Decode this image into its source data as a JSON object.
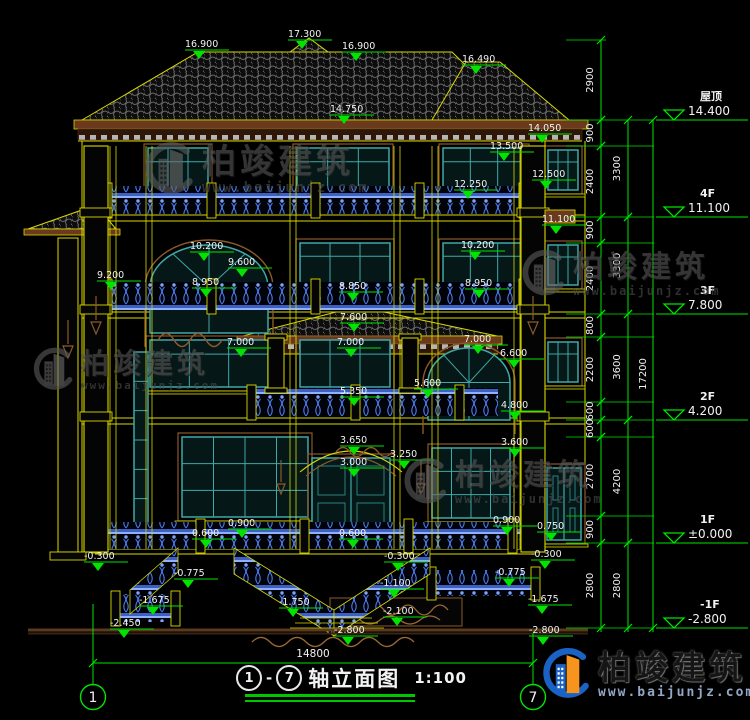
{
  "colors": {
    "green": "#00e400",
    "yellow": "#d8d800",
    "teal": "#3fa8a8",
    "blue": "#4a78e8",
    "brown": "#8a5a2b",
    "white": "#f2f2f2"
  },
  "brand": {
    "name": "柏竣建筑",
    "url": "www.baijunjz.com"
  },
  "title_block": {
    "axis_start": "1",
    "axis_end": "7",
    "separator": "-",
    "title": "轴立面图",
    "scale": "1:100"
  },
  "overall_dimension": "14800",
  "axis_bubbles": [
    {
      "label": "1",
      "x": 93,
      "y": 697
    },
    {
      "label": "7",
      "x": 533,
      "y": 697
    }
  ],
  "levels": [
    {
      "name": "屋顶",
      "value": "14.400",
      "y": 120
    },
    {
      "name": "4F",
      "value": "11.100",
      "y": 217
    },
    {
      "name": "3F",
      "value": "7.800",
      "y": 314
    },
    {
      "name": "2F",
      "value": "4.200",
      "y": 420
    },
    {
      "name": "1F",
      "value": "±0.000",
      "y": 543
    },
    {
      "name": "-1F",
      "value": "-2.800",
      "y": 628
    }
  ],
  "dim_chains": [
    {
      "x": 601,
      "text_x": 593,
      "top": 40,
      "segments": [
        {
          "value": "2900",
          "y1": 40,
          "y2": 120
        },
        {
          "value": "900",
          "y1": 120,
          "y2": 146
        },
        {
          "value": "2400",
          "y1": 146,
          "y2": 217
        },
        {
          "value": "900",
          "y1": 217,
          "y2": 243
        },
        {
          "value": "2400",
          "y1": 243,
          "y2": 314
        },
        {
          "value": "800",
          "y1": 314,
          "y2": 337
        },
        {
          "value": "2200",
          "y1": 337,
          "y2": 402
        },
        {
          "value": "600",
          "y1": 402,
          "y2": 420
        },
        {
          "value": "600",
          "y1": 420,
          "y2": 437
        },
        {
          "value": "2700",
          "y1": 437,
          "y2": 516
        },
        {
          "value": "900",
          "y1": 516,
          "y2": 543
        },
        {
          "value": "2800",
          "y1": 543,
          "y2": 628
        }
      ]
    },
    {
      "x": 628,
      "text_x": 620,
      "top": 120,
      "segments": [
        {
          "value": "3300",
          "y1": 120,
          "y2": 217
        },
        {
          "value": "3300",
          "y1": 217,
          "y2": 314
        },
        {
          "value": "3600",
          "y1": 314,
          "y2": 420
        },
        {
          "value": "4200",
          "y1": 420,
          "y2": 543
        },
        {
          "value": "2800",
          "y1": 543,
          "y2": 628
        }
      ]
    },
    {
      "x": 653,
      "text_x": 646,
      "top": 120,
      "segments": [
        {
          "value": "17200",
          "y1": 120,
          "y2": 628
        }
      ]
    }
  ],
  "elevation_markers": [
    {
      "value": "16.900",
      "x": 205,
      "y": 50
    },
    {
      "value": "17.300",
      "x": 308,
      "y": 40
    },
    {
      "value": "16.900",
      "x": 362,
      "y": 52
    },
    {
      "value": "16.490",
      "x": 482,
      "y": 65
    },
    {
      "value": "14.750",
      "x": 350,
      "y": 115
    },
    {
      "value": "14.050",
      "x": 548,
      "y": 134
    },
    {
      "value": "13.500",
      "x": 510,
      "y": 152
    },
    {
      "value": "12.500",
      "x": 552,
      "y": 180
    },
    {
      "value": "12.250",
      "x": 474,
      "y": 190
    },
    {
      "value": "11.100",
      "x": 562,
      "y": 225
    },
    {
      "value": "10.200",
      "x": 210,
      "y": 252
    },
    {
      "value": "10.200",
      "x": 481,
      "y": 251
    },
    {
      "value": "9.600",
      "x": 248,
      "y": 268
    },
    {
      "value": "9.200",
      "x": 117,
      "y": 281
    },
    {
      "value": "8.950",
      "x": 212,
      "y": 288
    },
    {
      "value": "8.950",
      "x": 485,
      "y": 289
    },
    {
      "value": "8.850",
      "x": 359,
      "y": 292
    },
    {
      "value": "7.600",
      "x": 360,
      "y": 323
    },
    {
      "value": "7.000",
      "x": 247,
      "y": 348
    },
    {
      "value": "7.000",
      "x": 357,
      "y": 348
    },
    {
      "value": "7.000",
      "x": 484,
      "y": 345
    },
    {
      "value": "6.600",
      "x": 520,
      "y": 359
    },
    {
      "value": "5.600",
      "x": 434,
      "y": 389
    },
    {
      "value": "5.350",
      "x": 360,
      "y": 397
    },
    {
      "value": "4.800",
      "x": 521,
      "y": 411
    },
    {
      "value": "3.650",
      "x": 360,
      "y": 446
    },
    {
      "value": "3.600",
      "x": 521,
      "y": 448
    },
    {
      "value": "3.250",
      "x": 410,
      "y": 460
    },
    {
      "value": "3.000",
      "x": 360,
      "y": 468
    },
    {
      "value": "0.900",
      "x": 248,
      "y": 529
    },
    {
      "value": "0.900",
      "x": 513,
      "y": 526
    },
    {
      "value": "0.750",
      "x": 557,
      "y": 532
    },
    {
      "value": "0.600",
      "x": 212,
      "y": 539
    },
    {
      "value": "0.600",
      "x": 359,
      "y": 539
    },
    {
      "value": "-0.300",
      "x": 104,
      "y": 562
    },
    {
      "value": "-0.300",
      "x": 404,
      "y": 562
    },
    {
      "value": "-0.300",
      "x": 551,
      "y": 560
    },
    {
      "value": "-0.775",
      "x": 194,
      "y": 579
    },
    {
      "value": "-0.775",
      "x": 515,
      "y": 578
    },
    {
      "value": "-1.100",
      "x": 400,
      "y": 589
    },
    {
      "value": "-1.675",
      "x": 159,
      "y": 606
    },
    {
      "value": "-1.675",
      "x": 548,
      "y": 605
    },
    {
      "value": "-1.750",
      "x": 299,
      "y": 608
    },
    {
      "value": "-2.100",
      "x": 403,
      "y": 617
    },
    {
      "value": "-2.450",
      "x": 130,
      "y": 629
    },
    {
      "value": "-2.800",
      "x": 354,
      "y": 636
    },
    {
      "value": "-2.800",
      "x": 549,
      "y": 636
    }
  ],
  "watermarks": [
    {
      "x": 136,
      "y": 140,
      "variant": "gray",
      "text_px": 34
    },
    {
      "x": 514,
      "y": 248,
      "variant": "gray",
      "text_px": 30
    },
    {
      "x": 26,
      "y": 346,
      "variant": "gray",
      "text_px": 28
    },
    {
      "x": 396,
      "y": 456,
      "variant": "gray",
      "text_px": 30
    },
    {
      "x": 534,
      "y": 646,
      "variant": "color",
      "text_px": 33
    }
  ]
}
